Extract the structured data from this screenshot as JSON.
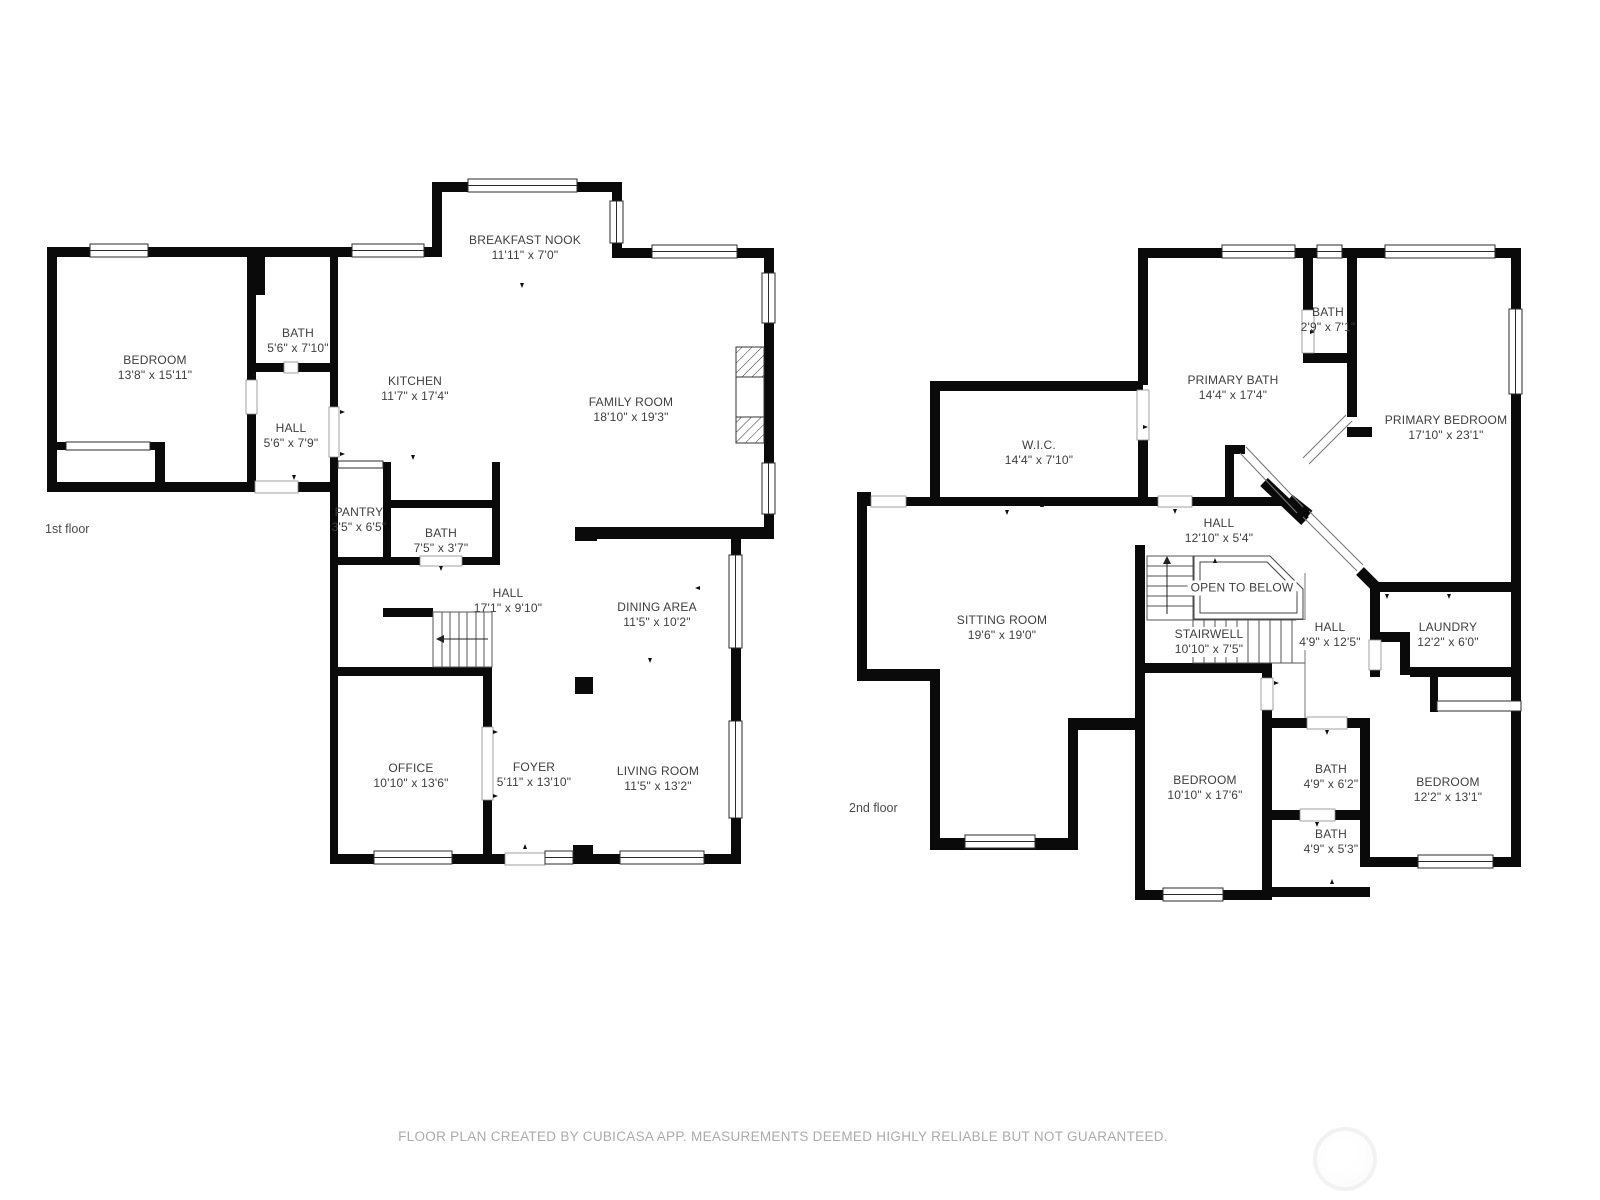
{
  "footer": {
    "text": "FLOOR PLAN CREATED BY CUBICASA APP. MEASUREMENTS DEEMED HIGHLY RELIABLE BUT NOT GUARANTEED."
  },
  "colors": {
    "wall": "#0a0a0a",
    "label_text": "#3e3e3e",
    "caption_text": "#4a4a4a",
    "footer_text": "#ababab",
    "window_line": "#2b2b2b",
    "stair_line": "#555555"
  },
  "watermark": {
    "shape": "circle-logo-ghost"
  },
  "floors": [
    {
      "caption": "1st floor",
      "caption_x": 45,
      "caption_y": 522,
      "rooms": [
        {
          "name": "BEDROOM",
          "dims": "13'8\" x 15'11\"",
          "x": 155,
          "y": 368,
          "halo": false
        },
        {
          "name": "BATH",
          "dims": "5'6\" x 7'10\"",
          "x": 298,
          "y": 341,
          "halo": false
        },
        {
          "name": "HALL",
          "dims": "5'6\" x 7'9\"",
          "x": 291,
          "y": 436,
          "halo": false
        },
        {
          "name": "KITCHEN",
          "dims": "11'7\" x 17'4\"",
          "x": 415,
          "y": 389,
          "halo": false
        },
        {
          "name": "BREAKFAST NOOK",
          "dims": "11'11\" x 7'0\"",
          "x": 525,
          "y": 248,
          "halo": false
        },
        {
          "name": "FAMILY ROOM",
          "dims": "18'10\" x 19'3\"",
          "x": 631,
          "y": 410,
          "halo": false
        },
        {
          "name": "PANTRY",
          "dims": "3'5\" x 6'5\"",
          "x": 359,
          "y": 520,
          "halo": false
        },
        {
          "name": "BATH",
          "dims": "7'5\" x 3'7\"",
          "x": 441,
          "y": 541,
          "halo": false
        },
        {
          "name": "HALL",
          "dims": "17'1\" x 9'10\"",
          "x": 508,
          "y": 601,
          "halo": false
        },
        {
          "name": "DINING AREA",
          "dims": "11'5\" x 10'2\"",
          "x": 657,
          "y": 615,
          "halo": false
        },
        {
          "name": "OFFICE",
          "dims": "10'10\" x 13'6\"",
          "x": 411,
          "y": 776,
          "halo": false
        },
        {
          "name": "FOYER",
          "dims": "5'11\" x 13'10\"",
          "x": 534,
          "y": 775,
          "halo": false
        },
        {
          "name": "LIVING ROOM",
          "dims": "11'5\" x 13'2\"",
          "x": 658,
          "y": 779,
          "halo": false
        }
      ]
    },
    {
      "caption": "2nd floor",
      "caption_x": 849,
      "caption_y": 801,
      "rooms": [
        {
          "name": "BATH",
          "dims": "2'9\" x 7'1\"",
          "x": 1328,
          "y": 320,
          "halo": false
        },
        {
          "name": "PRIMARY BATH",
          "dims": "14'4\" x 17'4\"",
          "x": 1233,
          "y": 388,
          "halo": false
        },
        {
          "name": "PRIMARY BEDROOM",
          "dims": "17'10\" x 23'1\"",
          "x": 1446,
          "y": 428,
          "halo": false
        },
        {
          "name": "W.I.C.",
          "dims": "14'4\" x 7'10\"",
          "x": 1039,
          "y": 453,
          "halo": false
        },
        {
          "name": "HALL",
          "dims": "12'10\" x 5'4\"",
          "x": 1219,
          "y": 531,
          "halo": false
        },
        {
          "name": "OPEN TO BELOW",
          "dims": "",
          "x": 1242,
          "y": 588,
          "halo": true
        },
        {
          "name": "SITTING ROOM",
          "dims": "19'6\" x 19'0\"",
          "x": 1002,
          "y": 628,
          "halo": false
        },
        {
          "name": "STAIRWELL",
          "dims": "10'10\" x 7'5\"",
          "x": 1209,
          "y": 642,
          "halo": true
        },
        {
          "name": "HALL",
          "dims": "4'9\" x 12'5\"",
          "x": 1330,
          "y": 635,
          "halo": true
        },
        {
          "name": "LAUNDRY",
          "dims": "12'2\" x 6'0\"",
          "x": 1448,
          "y": 635,
          "halo": false
        },
        {
          "name": "BEDROOM",
          "dims": "10'10\" x 17'6\"",
          "x": 1205,
          "y": 788,
          "halo": false
        },
        {
          "name": "BATH",
          "dims": "4'9\" x 6'2\"",
          "x": 1331,
          "y": 777,
          "halo": false
        },
        {
          "name": "BATH",
          "dims": "4'9\" x 5'3\"",
          "x": 1331,
          "y": 842,
          "halo": false
        },
        {
          "name": "BEDROOM",
          "dims": "12'2\" x 13'1\"",
          "x": 1448,
          "y": 790,
          "halo": false
        }
      ]
    }
  ]
}
